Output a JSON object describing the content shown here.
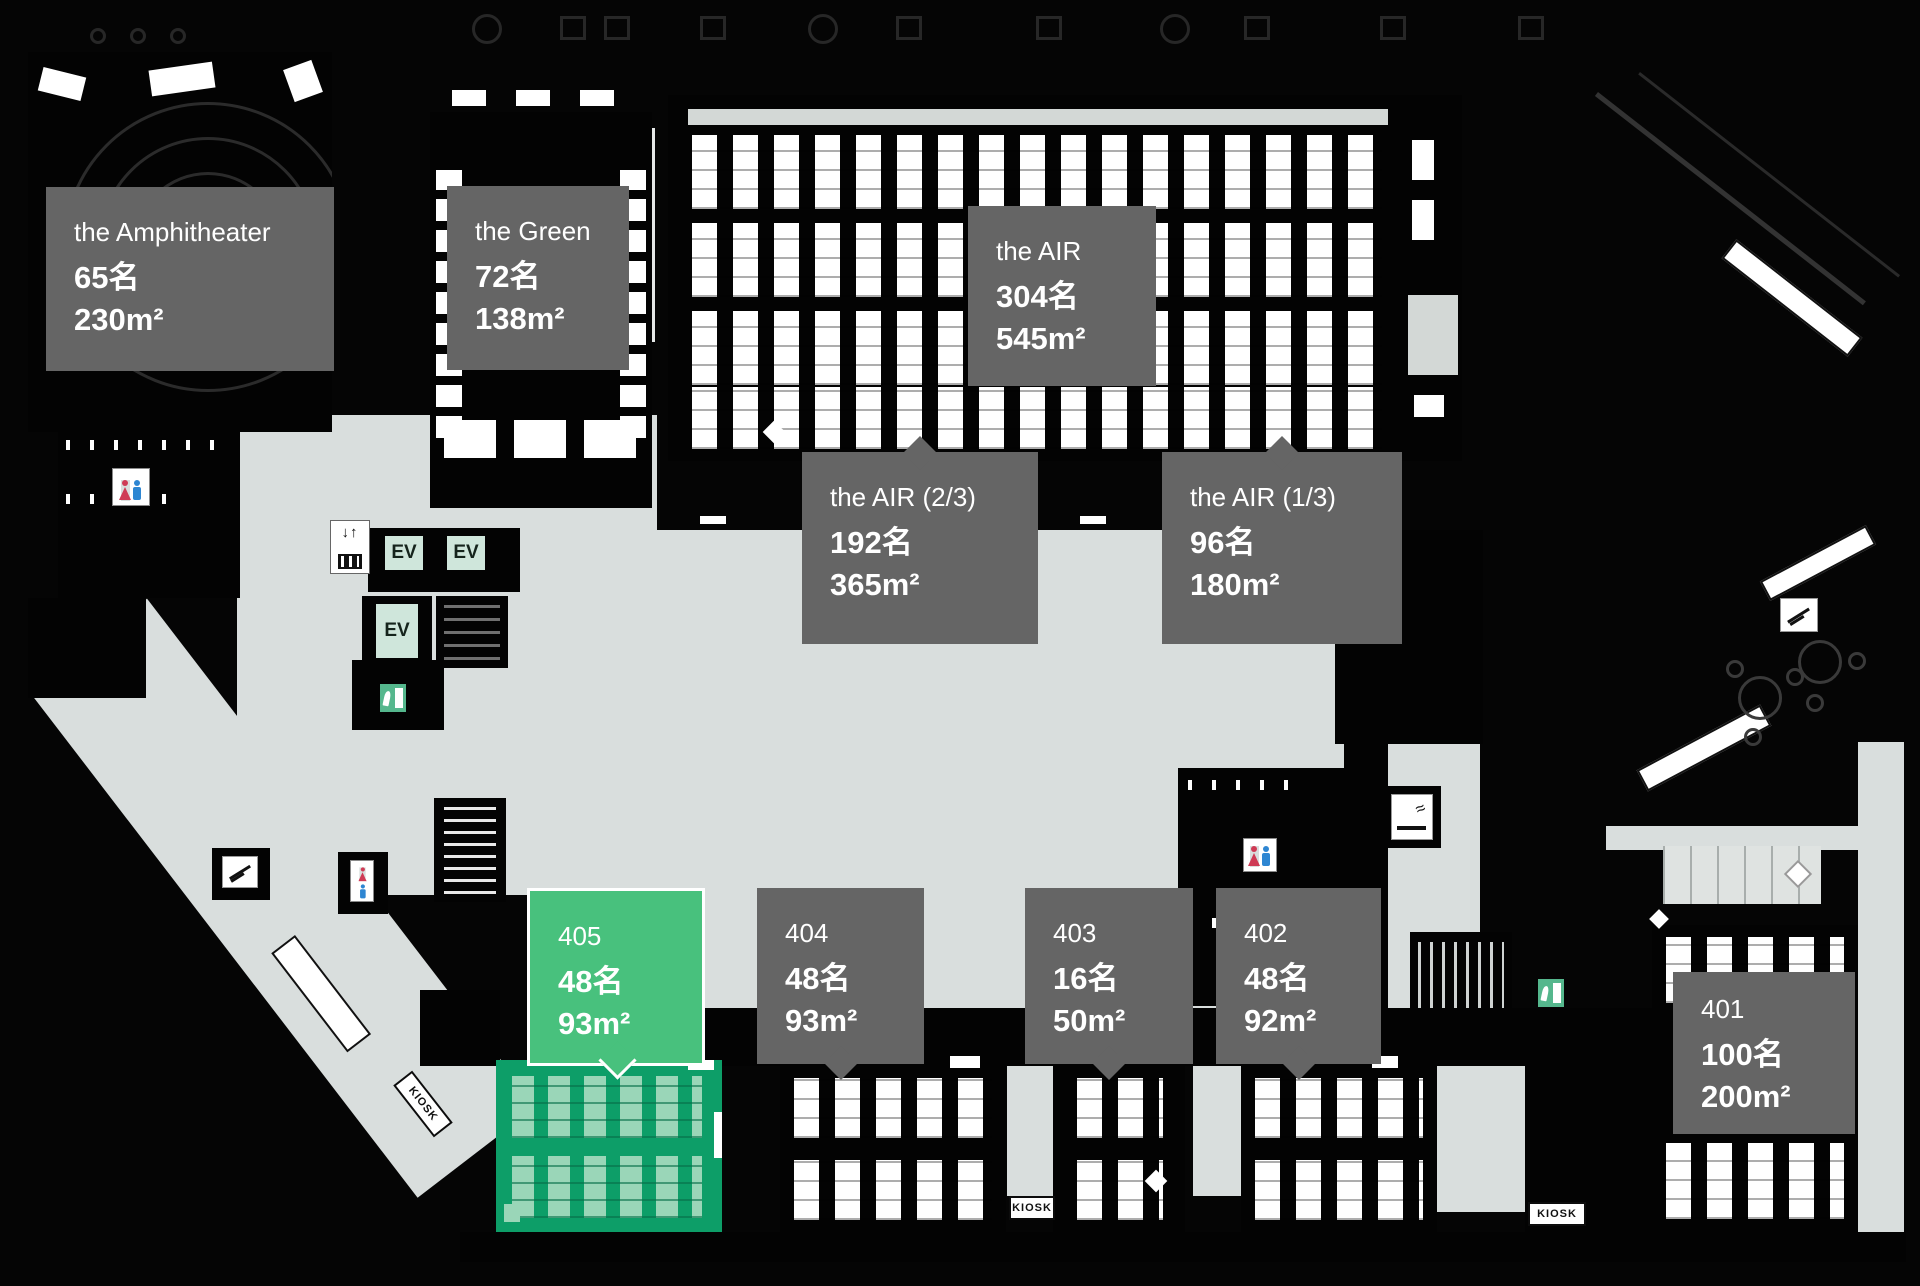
{
  "colors": {
    "floor": "#d9dedd",
    "label_bg": "#656565",
    "highlight_label": "#48c17d",
    "highlight_room": "#0d9e68",
    "highlight_furniture": "#9ad6b8",
    "ev_bg": "#cfe6db",
    "exit_green": "#55b78d",
    "wc_female": "#cf3b55",
    "wc_male": "#2e86d2"
  },
  "labels": [
    {
      "name": "the Amphitheater",
      "capacity": "65名",
      "area": "230m²"
    },
    {
      "name": "the Green",
      "capacity": "72名",
      "area": "138m²"
    },
    {
      "name": "the AIR",
      "capacity": "304名",
      "area": "545m²"
    },
    {
      "name": "the AIR (2/3)",
      "capacity": "192名",
      "area": "365m²"
    },
    {
      "name": "the AIR (1/3)",
      "capacity": "96名",
      "area": "180m²"
    },
    {
      "name": "405",
      "capacity": "48名",
      "area": "93m²",
      "highlighted": true
    },
    {
      "name": "404",
      "capacity": "48名",
      "area": "93m²"
    },
    {
      "name": "403",
      "capacity": "16名",
      "area": "50m²"
    },
    {
      "name": "402",
      "capacity": "48名",
      "area": "92m²"
    },
    {
      "name": "401",
      "capacity": "100名",
      "area": "200m²"
    }
  ],
  "markers": {
    "ev": "EV",
    "kiosk": "KIOSK"
  }
}
